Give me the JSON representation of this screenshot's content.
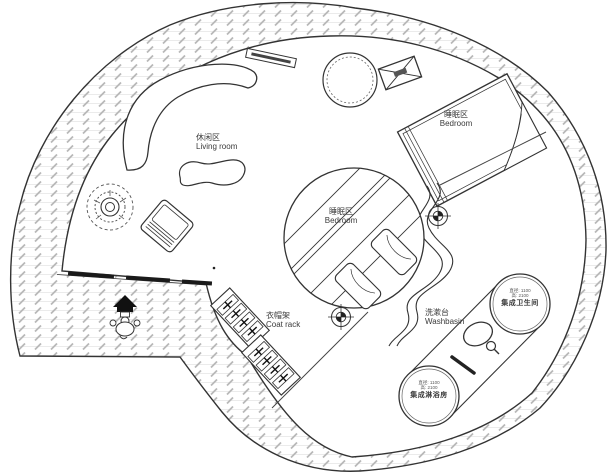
{
  "plan": {
    "areas": {
      "living": {
        "zh": "休闲区",
        "en": "Living room"
      },
      "bedroom_upper": {
        "zh": "睡眠区",
        "en": "Bedroom"
      },
      "bedroom_center": {
        "zh": "睡眠区",
        "en": "Bedroom"
      },
      "coat_rack": {
        "zh": "衣帽架",
        "en": "Coat rack"
      },
      "washbasin": {
        "zh": "洗漱台",
        "en": "Washbasin"
      },
      "toilet_pod": {
        "name": "集成卫生间",
        "spec1": "直径: 1100",
        "spec2": "高: 2100"
      },
      "shower_pod": {
        "name": "集成淋浴房",
        "spec1": "直径: 1100",
        "spec2": "高: 2100"
      }
    },
    "colors": {
      "background": "#ffffff",
      "wall_line": "#333333",
      "hatch_dash": "#b8b8b8",
      "hatch_grid": "#e3e3e3",
      "threshold": "#1a1a1a"
    }
  }
}
